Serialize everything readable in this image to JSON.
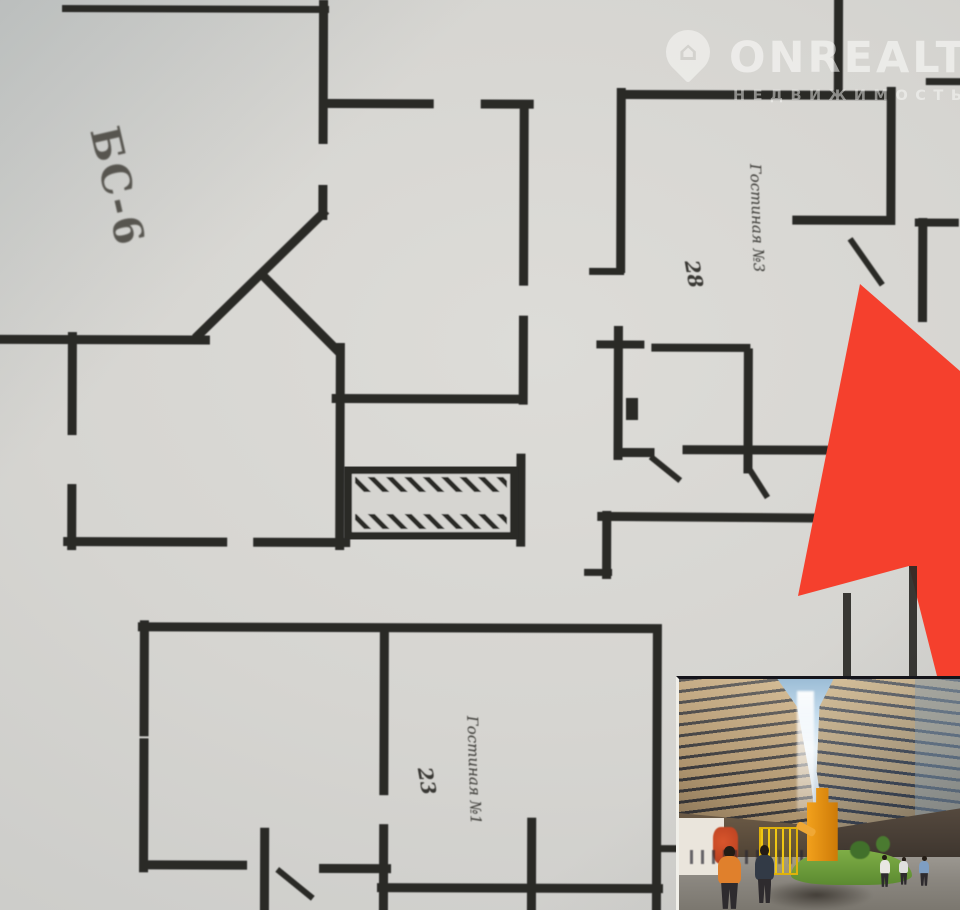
{
  "watermark": {
    "brand": "ONREALT",
    "tagline": "НЕДВИЖИМОСТЬ",
    "icon": "map-pin-house-icon",
    "icon_glyph": "⌂",
    "color": "rgba(253,253,251,0.55)"
  },
  "plan": {
    "block_label": "БС-6",
    "room_top_right": {
      "name": "Гостиная №3",
      "area": "28"
    },
    "room_bottom": {
      "name": "Гостиная №1",
      "area": "23"
    },
    "colors": {
      "paper": "#d6d5d1",
      "wall": "#2b2a26"
    }
  },
  "arrow": {
    "color": "#f5402d"
  },
  "photo": {
    "subject": "двор жилого комплекса с детской площадкой"
  }
}
